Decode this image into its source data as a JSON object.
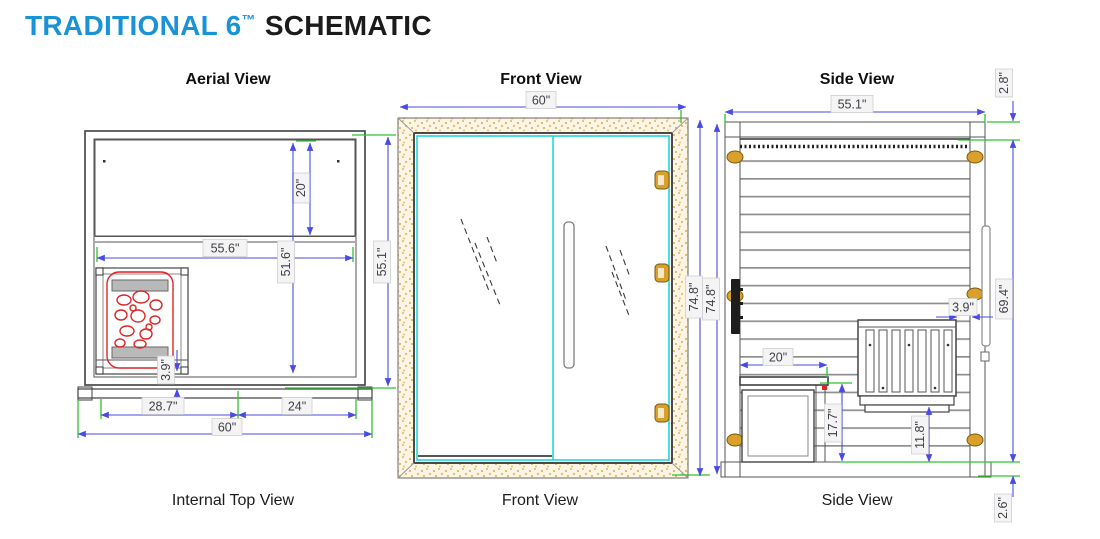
{
  "title": {
    "brand": "TRADITIONAL 6",
    "trademark": "™",
    "suffix": "SCHEMATIC"
  },
  "colors": {
    "brand_blue": "#1a93d6",
    "dimension_blue": "#4a4ae4",
    "extension_green": "#2cc32c",
    "heater_red": "#e02424",
    "glass_cyan": "#1fd9d9",
    "wood_tan": "#e2b364",
    "hinge_gold": "#d9a02c"
  },
  "views": {
    "aerial": {
      "label": "Aerial View",
      "caption": "Internal Top View",
      "dims": {
        "bench_depth": "20\"",
        "interior_width": "55.6\"",
        "interior_depth": "51.6\"",
        "overall_depth": "55.1\"",
        "heater_gap": "3.9\"",
        "left_span": "28.7\"",
        "right_span": "24\"",
        "overall_width": "60\""
      }
    },
    "front": {
      "label": "Front View",
      "caption": "Front View",
      "dims": {
        "width": "60\"",
        "height": "74.8\"",
        "height2": "74.8\""
      }
    },
    "side": {
      "label": "Side View",
      "caption": "Side View",
      "dims": {
        "depth": "55.1\"",
        "roof": "2.8\"",
        "interior_height": "69.4\"",
        "bench_depth": "20\"",
        "bench_height": "17.7\"",
        "heater_gap": "3.9\"",
        "heater_height": "11.8\"",
        "floor": "2.6\""
      }
    }
  }
}
